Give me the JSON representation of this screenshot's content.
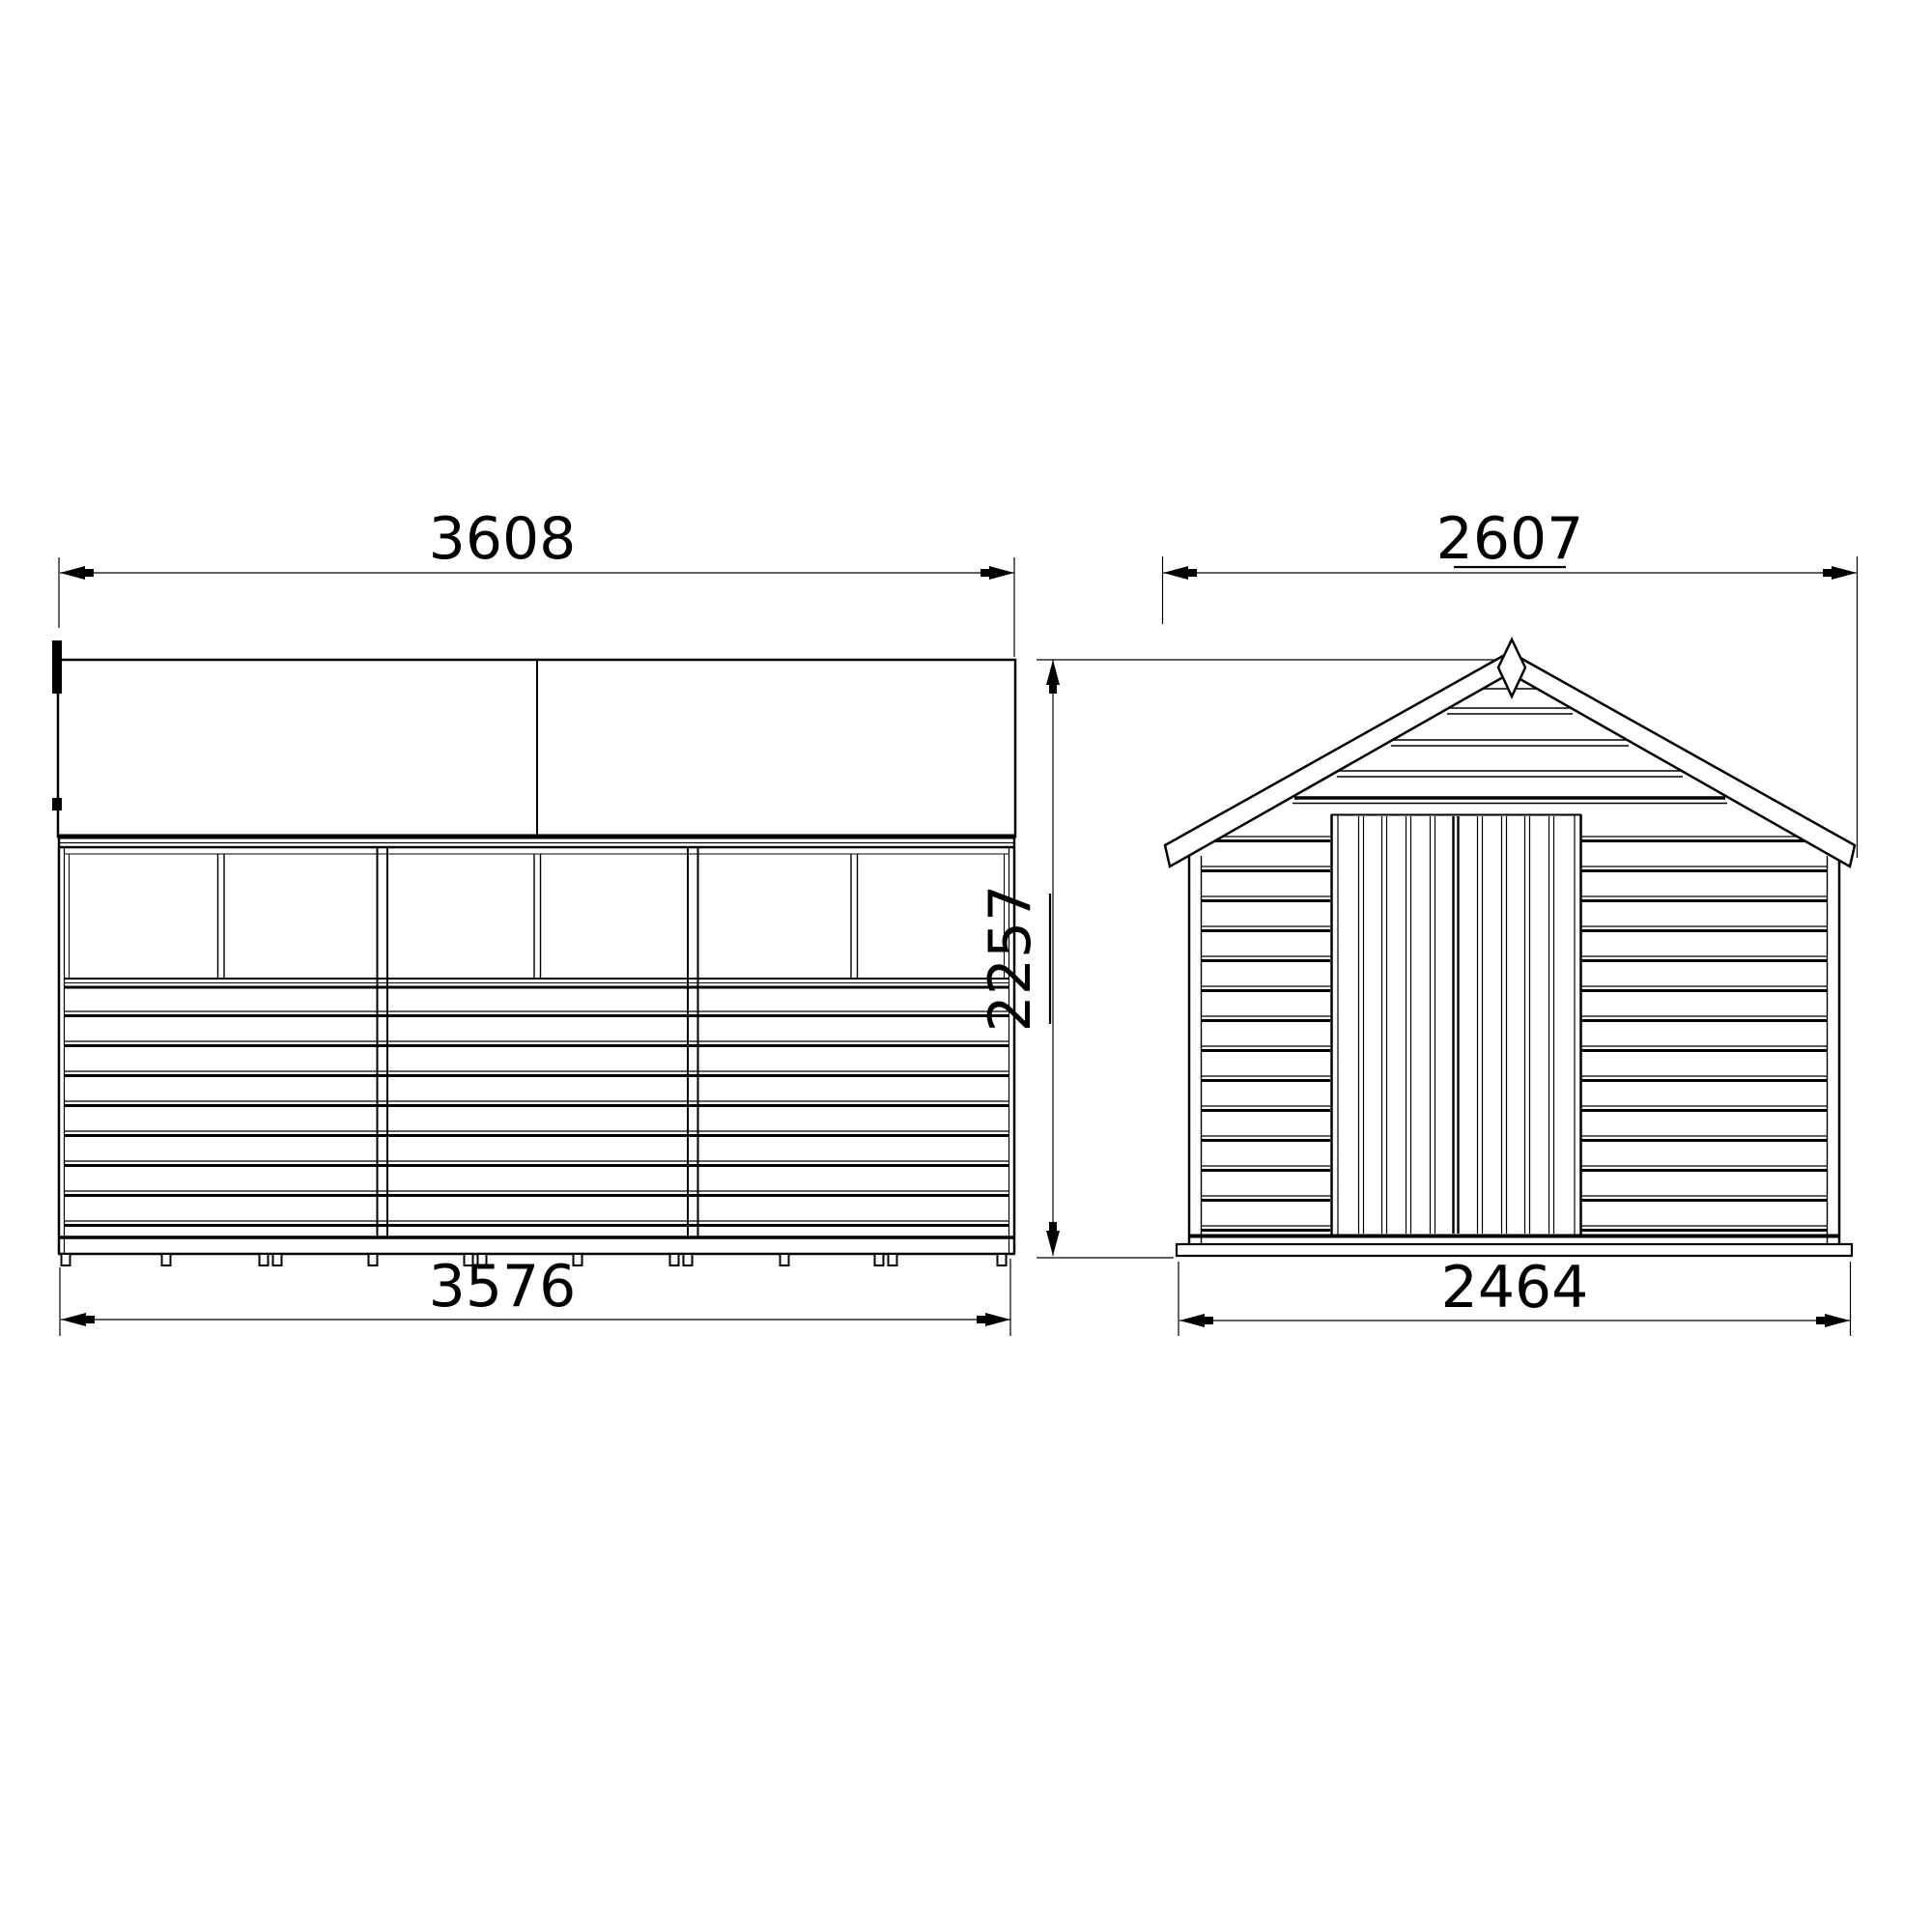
{
  "drawing": {
    "side_elevation": {
      "overall_width": "3608",
      "base_width": "3576"
    },
    "front_elevation": {
      "overall_width": "2607",
      "overall_height": "2257",
      "base_width": "2464"
    }
  },
  "colors": {
    "line": "#000000",
    "background": "#ffffff"
  }
}
